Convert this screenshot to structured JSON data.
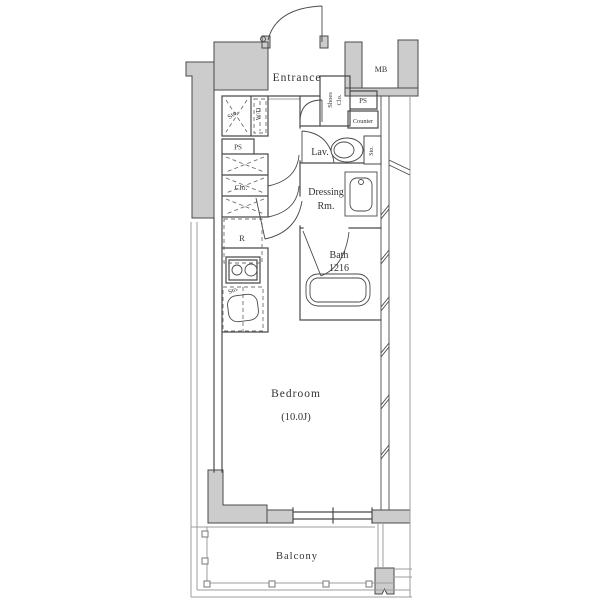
{
  "plan": {
    "title": "Studio apartment floor plan",
    "labels": {
      "entrance": "Entrance",
      "mb": "MB",
      "storage_top": "Sto.",
      "washer_dryer": "W/D",
      "pipe_space_left": "PS",
      "shoes_closet_line1": "Shoes",
      "shoes_closet_line2": "Clo.",
      "pipe_space_right": "PS",
      "counter": "Counter",
      "lavatory": "Lav.",
      "toilet_storage": "Sto.",
      "dressing_line1": "Dressing",
      "dressing_line2": "Rm.",
      "bath_line1": "Bath",
      "bath_line2": "1216",
      "closet": "Clo.",
      "refrigerator": "R",
      "kitchen_storage": "Sto.",
      "bedroom_name": "Bedroom",
      "bedroom_size": "(10.0J)",
      "balcony": "Balcony"
    },
    "colors": {
      "wall_fill": "#cccccc",
      "wall_line": "#4a4a4a",
      "light_line": "#9e9e9e",
      "dash_line": "#707070",
      "text": "#333333",
      "background": "#ffffff"
    }
  }
}
